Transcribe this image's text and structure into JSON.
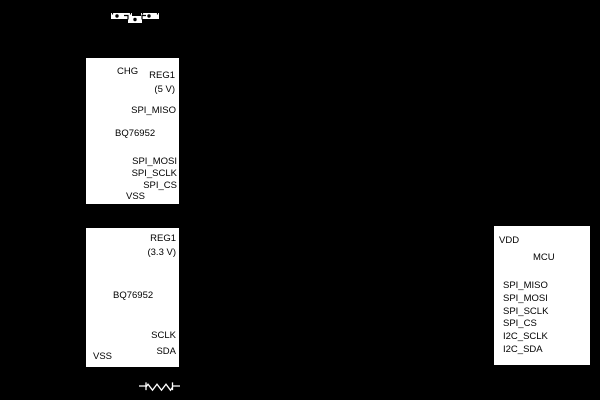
{
  "colors": {
    "background": "#000000",
    "block_fill": "#ffffff",
    "block_text": "#000000",
    "symbol_stroke": "#ffffff",
    "symbol_detail": "#000000"
  },
  "blocks": {
    "afe_top": {
      "part": "BQ76952",
      "pin_chg": "CHG",
      "reg1": "REG1",
      "reg1_voltage": "(5 V)",
      "pin_spi_miso": "SPI_MISO",
      "pin_spi_mosi": "SPI_MOSI",
      "pin_spi_sclk": "SPI_SCLK",
      "pin_spi_cs": "SPI_CS",
      "pin_vss": "VSS"
    },
    "afe_bottom": {
      "part": "BQ76952",
      "reg1": "REG1",
      "reg1_voltage": "(3.3 V)",
      "pin_sclk": "SCLK",
      "pin_sda": "SDA",
      "pin_vss": "VSS"
    },
    "mcu": {
      "part": "MCU",
      "pin_vdd": "VDD",
      "pins": [
        "SPI_MISO",
        "SPI_MOSI",
        "SPI_SCLK",
        "SPI_CS",
        "I2C_SCLK",
        "I2C_SDA"
      ]
    }
  },
  "symbols": {
    "fet_pair": "chg-dsg-fet-pair",
    "sense_resistor": "sense-resistor"
  }
}
